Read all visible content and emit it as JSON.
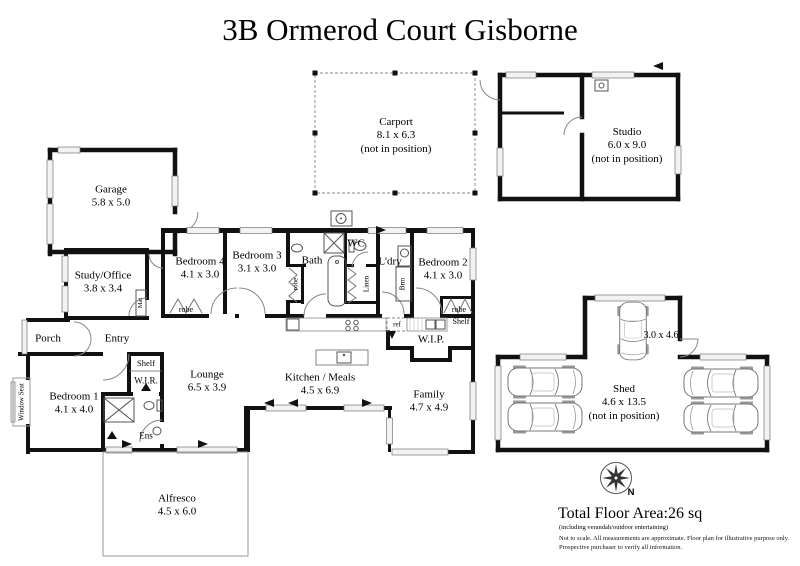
{
  "title": "3B Ormerod Court Gisborne",
  "rooms": {
    "carport": {
      "name": "Carport",
      "dims": "8.1 x 6.3",
      "note": "(not in position)"
    },
    "studio": {
      "name": "Studio",
      "dims": "6.0 x 9.0",
      "note": "(not in position)"
    },
    "garage": {
      "name": "Garage",
      "dims": "5.8 x 5.0"
    },
    "study_office": {
      "name": "Study/Office",
      "dims": "3.8 x 3.4"
    },
    "porch": {
      "name": "Porch"
    },
    "entry": {
      "name": "Entry"
    },
    "bedroom_1": {
      "name": "Bedroom 1",
      "dims": "4.1 x 4.0"
    },
    "bedroom_2": {
      "name": "Bedroom 2",
      "dims": "4.1 x 3.0"
    },
    "bedroom_3": {
      "name": "Bedroom 3",
      "dims": "3.1 x 3.0"
    },
    "bedroom_4": {
      "name": "Bedroom 4",
      "dims": "4.1 x 3.0"
    },
    "lounge": {
      "name": "Lounge",
      "dims": "6.5 x 3.9"
    },
    "kitchen_meals": {
      "name": "Kitchen / Meals",
      "dims": "4.5 x 6.9"
    },
    "family": {
      "name": "Family",
      "dims": "4.7 x 4.9"
    },
    "bath": {
      "name": "Bath"
    },
    "wc": {
      "name": "WC"
    },
    "laundry": {
      "name": "L'dry"
    },
    "wip": {
      "name": "W.I.P."
    },
    "wir": {
      "name": "W.I.R."
    },
    "ensuite": {
      "name": "Ens"
    },
    "alfresco": {
      "name": "Alfresco",
      "dims": "4.5 x 6.0"
    },
    "shed": {
      "name": "Shed",
      "dims": "4.6 x 13.5",
      "note": "(not in position)",
      "annex_dims": "3.0 x 4.6"
    }
  },
  "fixtures": {
    "robe": "robe",
    "shelf": "Shelf",
    "linen": "Linen",
    "broom": "Brm",
    "mat": "Mat",
    "fridge": "ref",
    "window_seat": "Window Seat"
  },
  "compass": {
    "north_label": "N"
  },
  "footer": {
    "total_area": "Total Floor Area:26 sq",
    "area_note": "(including verandah/outdoor entertaining)",
    "disclaimer_line1": "Not to scale. All measurements are approximate. Floor plan for illustrative purpose only.",
    "disclaimer_line2": "Prospective purchaser to verify all information."
  }
}
